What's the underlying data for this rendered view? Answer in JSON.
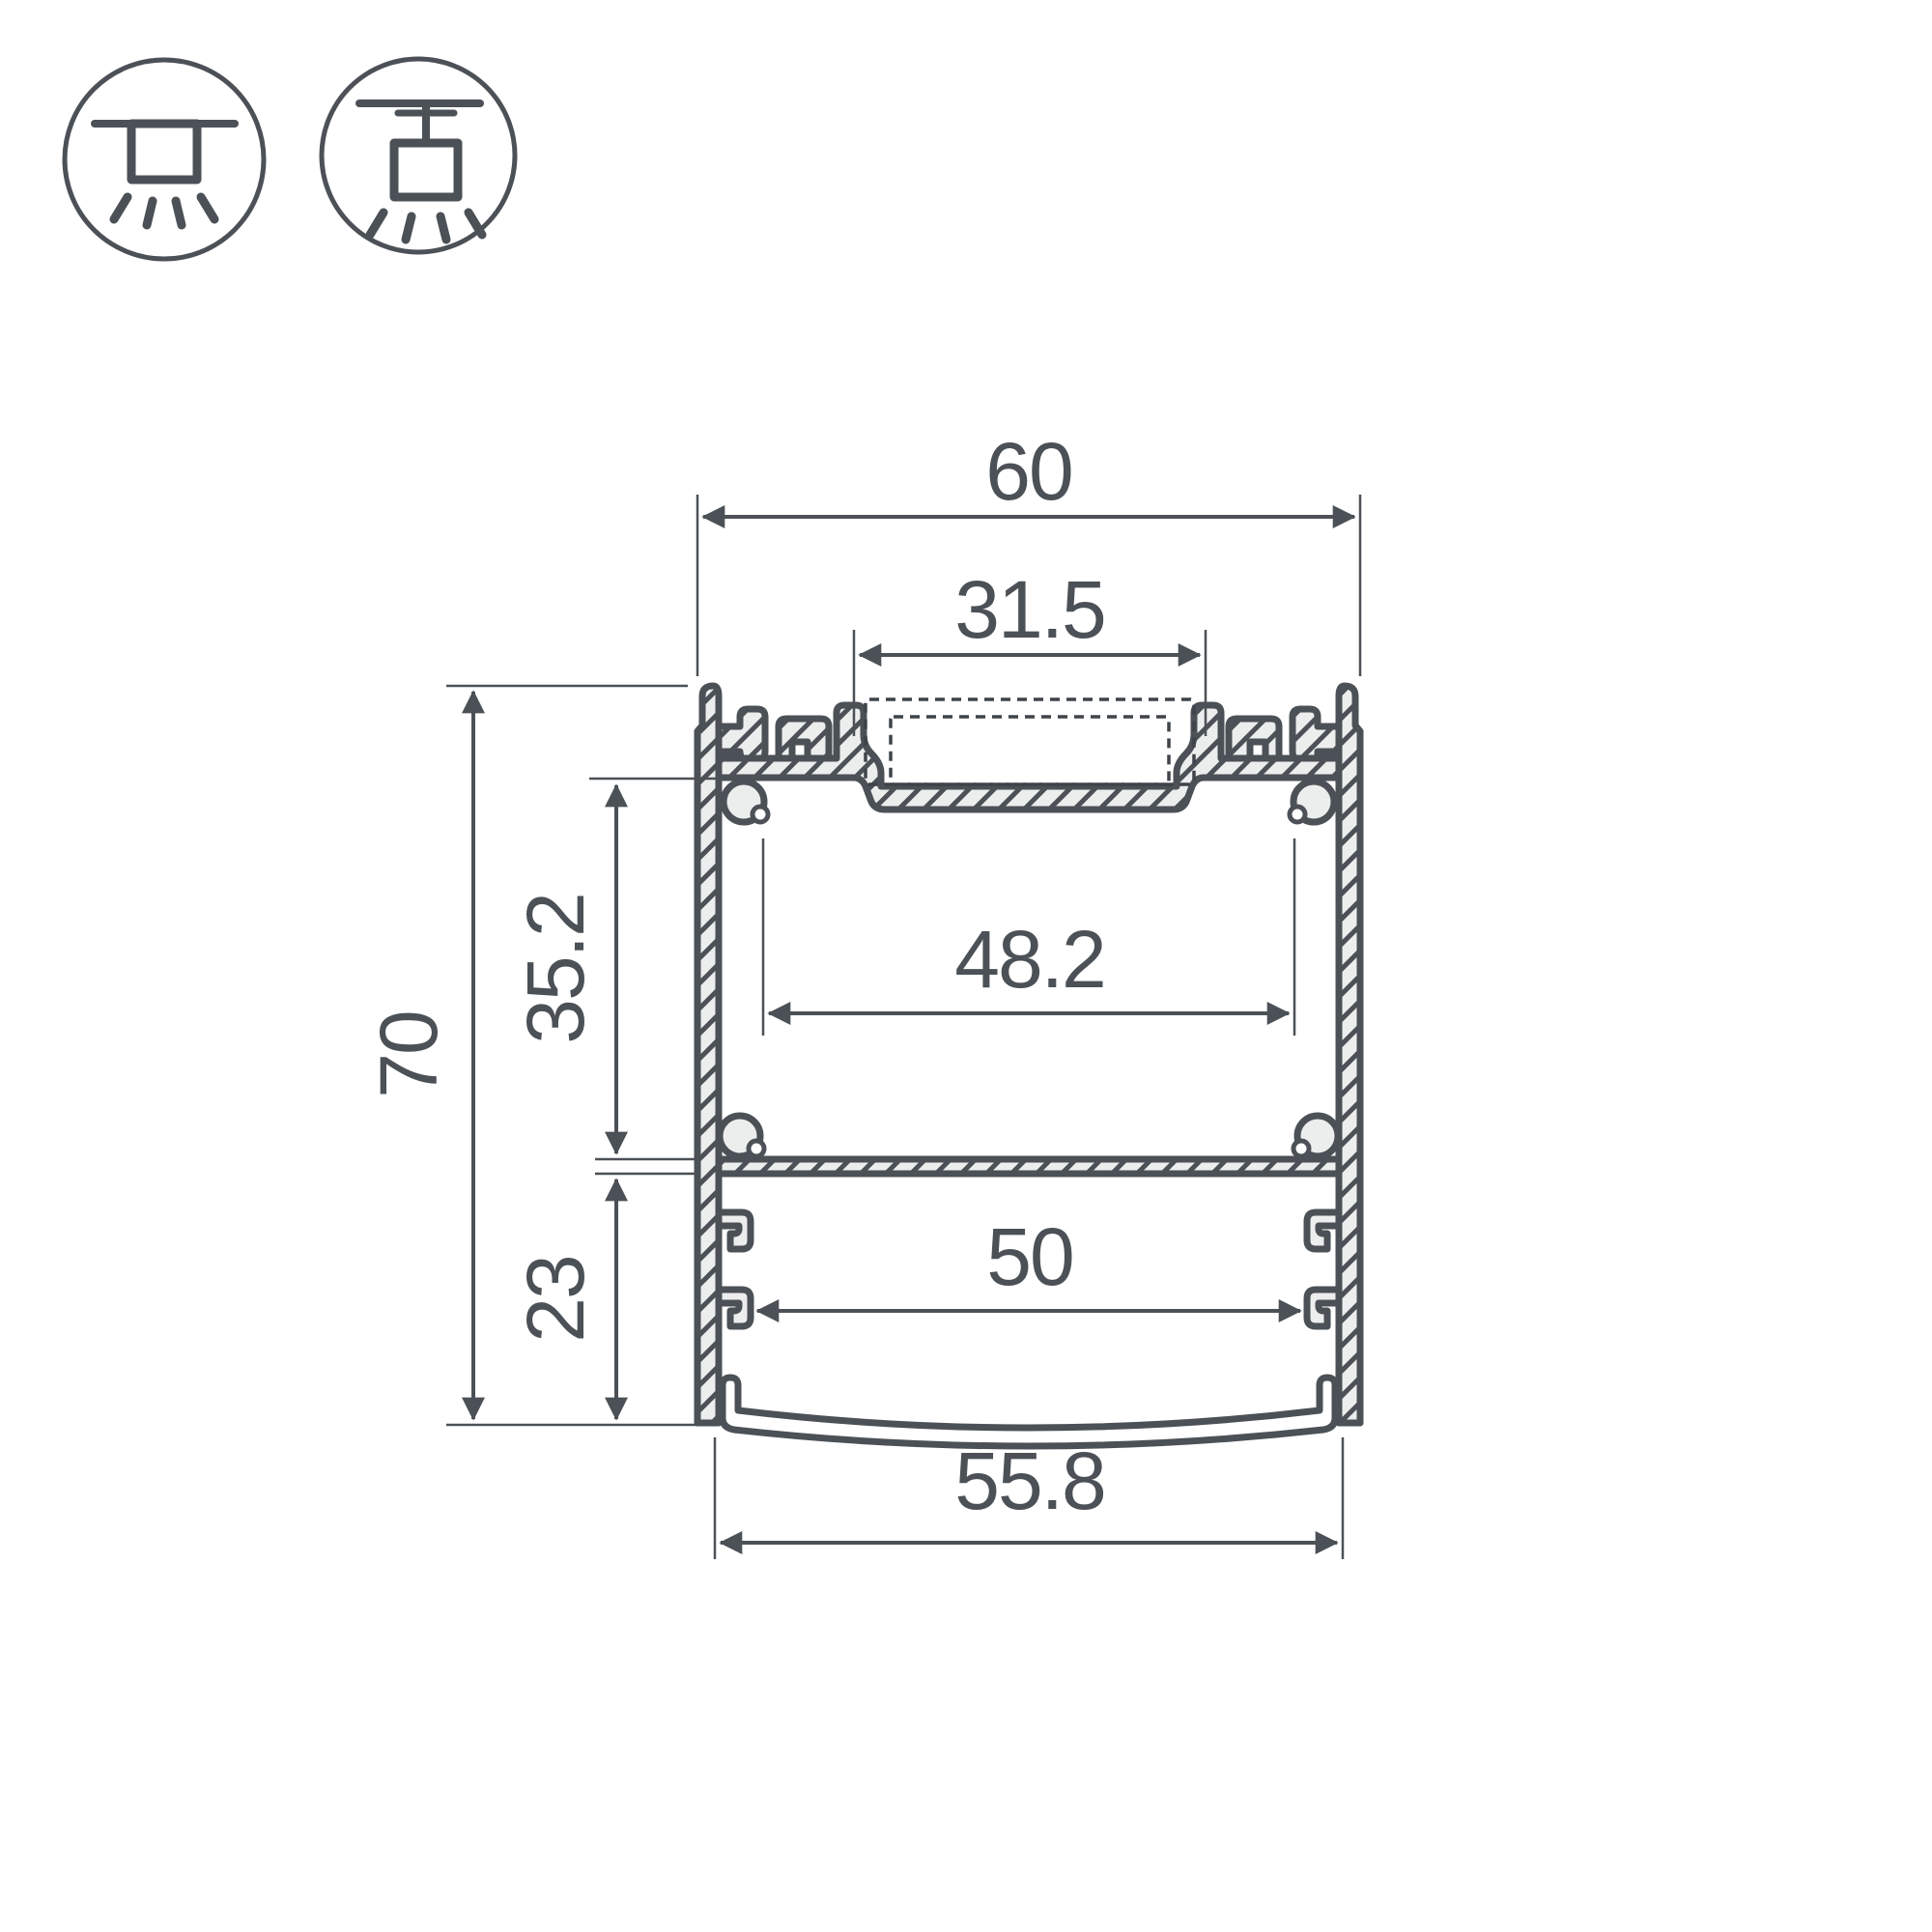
{
  "page": {
    "background": "#ffffff",
    "title": "LED profile cross-section technical drawing"
  },
  "colors": {
    "line": "#4b5156",
    "fill_light": "#ECEDED",
    "white": "#ffffff"
  },
  "icons": {
    "surface_mount": {
      "name": "surface-mount-icon"
    },
    "pendant_mount": {
      "name": "pendant-mount-icon"
    }
  },
  "dimensions": {
    "outer_width": "60",
    "channel_width": "31.5",
    "upper_inner_width": "48.2",
    "upper_cavity_height": "35.2",
    "total_height": "70",
    "lower_cavity_height": "23",
    "lower_inner_width": "50",
    "diffuser_width": "55.8"
  }
}
